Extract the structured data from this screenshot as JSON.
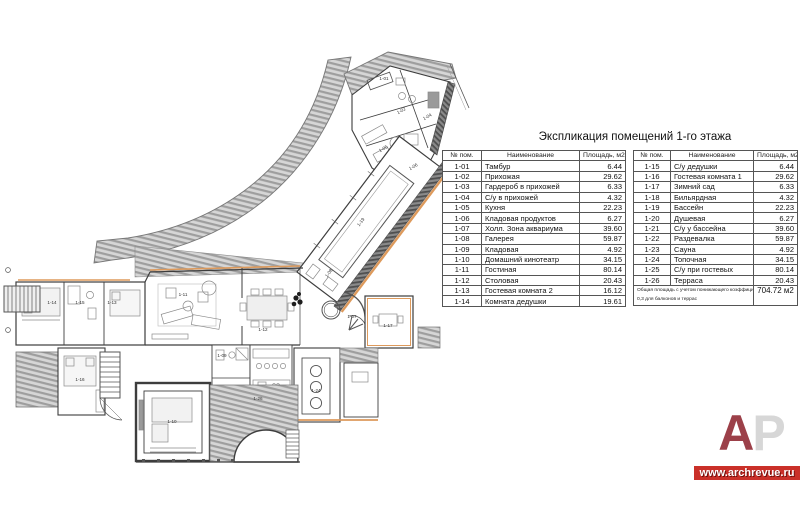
{
  "title": "Экспликация помещений 1-го этажа",
  "tables": [
    {
      "headers": [
        "№ пом.",
        "Наименование",
        "Площадь, м2"
      ],
      "rows": [
        [
          "1-01",
          "Тамбур",
          "6.44"
        ],
        [
          "1-02",
          "Прихожая",
          "29.62"
        ],
        [
          "1-03",
          "Гардероб в прихожей",
          "6.33"
        ],
        [
          "1-04",
          "С/у в прихожей",
          "4.32"
        ],
        [
          "1-05",
          "Кухня",
          "22.23"
        ],
        [
          "1-06",
          "Кладовая продуктов",
          "6.27"
        ],
        [
          "1-07",
          "Холл. Зона аквариума",
          "39.60"
        ],
        [
          "1-08",
          "Галерея",
          "59.87"
        ],
        [
          "1-09",
          "Кладовая",
          "4.92"
        ],
        [
          "1-10",
          "Домашний кинотеатр",
          "34.15"
        ],
        [
          "1-11",
          "Гостиная",
          "80.14"
        ],
        [
          "1-12",
          "Столовая",
          "20.43"
        ],
        [
          "1-13",
          "Гостевая комната 2",
          "16.12"
        ],
        [
          "1-14",
          "Комната дедушки",
          "19.61"
        ]
      ]
    },
    {
      "headers": [
        "№ пом.",
        "Наименование",
        "Площадь, м2"
      ],
      "rows": [
        [
          "1-15",
          "С/у дедушки",
          "6.44"
        ],
        [
          "1-16",
          "Гостевая комната 1",
          "29.62"
        ],
        [
          "1-17",
          "Зимний сад",
          "6.33"
        ],
        [
          "1-18",
          "Бильярдная",
          "4.32"
        ],
        [
          "1-19",
          "Бассейн",
          "22.23"
        ],
        [
          "1-20",
          "Душевая",
          "6.27"
        ],
        [
          "1-21",
          "С/у у бассейна",
          "39.60"
        ],
        [
          "1-22",
          "Раздевалка",
          "59.87"
        ],
        [
          "1-23",
          "Сауна",
          "4.92"
        ],
        [
          "1-24",
          "Топочная",
          "34.15"
        ],
        [
          "1-25",
          "С/у при гостевых",
          "80.14"
        ],
        [
          "1-26",
          "Терраса",
          "20.43"
        ]
      ],
      "footer": {
        "line1": "Общая площадь с учетом понижающего коэффициента",
        "line2": "0,3 для балконов и террас",
        "value": "704.72 м2"
      }
    }
  ],
  "plan": {
    "labels": [
      {
        "id": "1-01",
        "x": 384,
        "y": 80
      },
      {
        "id": "1-02",
        "x": 402,
        "y": 112,
        "r": -29
      },
      {
        "id": "1-04",
        "x": 428,
        "y": 118,
        "r": -29
      },
      {
        "id": "1-05",
        "x": 384,
        "y": 150,
        "r": -29
      },
      {
        "id": "1-06",
        "x": 414,
        "y": 168,
        "r": -29
      },
      {
        "id": "1-19",
        "x": 362,
        "y": 223,
        "r": -53
      },
      {
        "id": "1-08",
        "x": 330,
        "y": 274,
        "r": -53
      },
      {
        "id": "1-07",
        "x": 352,
        "y": 318
      },
      {
        "id": "1-17",
        "x": 388,
        "y": 327
      },
      {
        "id": "1-14",
        "x": 52,
        "y": 304
      },
      {
        "id": "1-15",
        "x": 80,
        "y": 304
      },
      {
        "id": "1-13",
        "x": 112,
        "y": 304
      },
      {
        "id": "1-11",
        "x": 183,
        "y": 296
      },
      {
        "id": "1-12",
        "x": 263,
        "y": 331
      },
      {
        "id": "1-16",
        "x": 80,
        "y": 381
      },
      {
        "id": "1-09",
        "x": 222,
        "y": 357
      },
      {
        "id": "1-10",
        "x": 172,
        "y": 423
      },
      {
        "id": "1-24",
        "x": 316,
        "y": 392
      },
      {
        "id": "1-26",
        "x": 258,
        "y": 400
      }
    ]
  },
  "logo": {
    "letter_a": "А",
    "letter_p": "Р",
    "site": "www.archrevue.ru"
  },
  "colors": {
    "wall": "#3d3d3d",
    "hatch_light": "#d6d6d6",
    "hatch_stripe": "#9e9e9e",
    "hatch_dark": "#8a8a8a",
    "accent_orange": "#dd9a5c",
    "logo_red": "#9c4049",
    "banner_red": "#ca3029"
  }
}
